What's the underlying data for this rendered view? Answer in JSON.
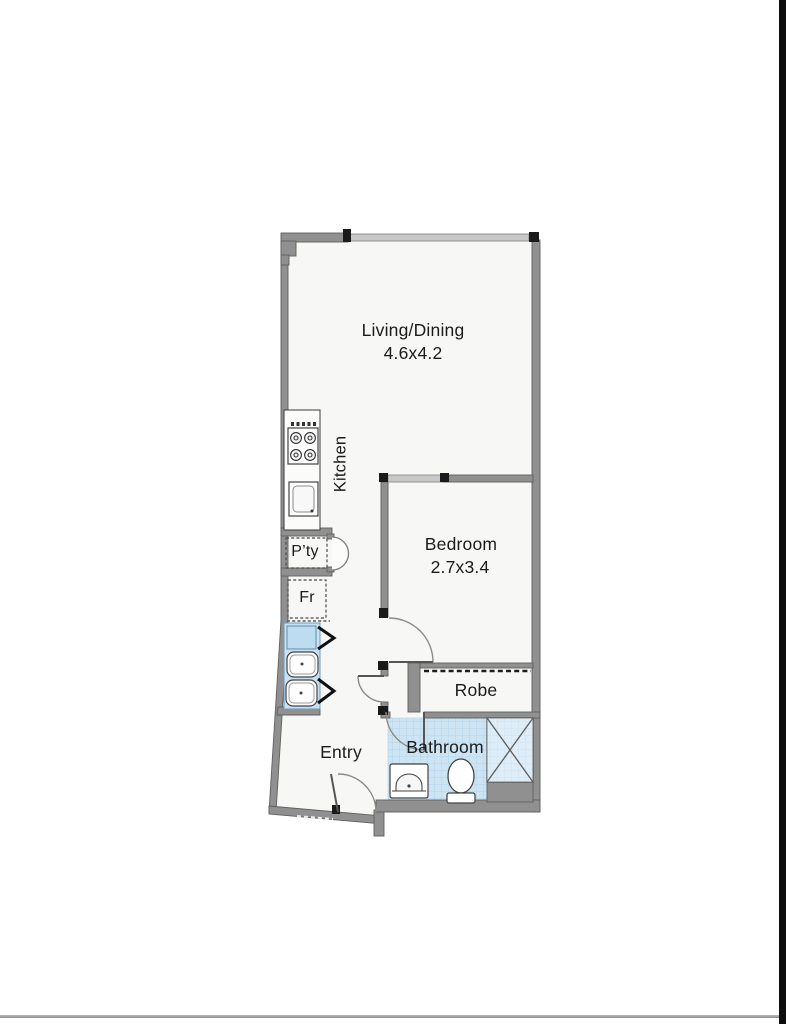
{
  "page": {
    "background": "#ffffff",
    "right_edge_bar_color": "#0e0e0e",
    "bottom_divider_color": "#9c9c9c"
  },
  "floorplan": {
    "colors": {
      "wall": "#909090",
      "wall_outline": "#5f5f5f",
      "window": "#c8c8c8",
      "post": "#1a1a1a",
      "floor": "#f7f7f5",
      "tile": "#cde4f3",
      "tile_grid": "#b3d3e8",
      "laundry_fill": "#c9e1f2",
      "door_arc": "#8a8a8a"
    },
    "rooms": {
      "living": {
        "label": "Living/Dining",
        "dims": "4.6x4.2"
      },
      "kitchen": {
        "label": "Kitchen"
      },
      "pantry": {
        "label": "P’ty"
      },
      "fridge": {
        "label": "Fr"
      },
      "bedroom": {
        "label": "Bedroom",
        "dims": "2.7x3.4"
      },
      "robe": {
        "label": "Robe"
      },
      "bathroom": {
        "label": "Bathroom"
      },
      "entry": {
        "label": "Entry"
      }
    },
    "fixtures": [
      "stove-icon",
      "kitchen-sink-icon",
      "pantry-door-icon",
      "fridge-space",
      "washer-icon",
      "laundry-tub-icon",
      "bifold-door-icon",
      "robe-sliding-track-icon",
      "shower-icon",
      "toilet-icon",
      "vanity-basin-icon",
      "door-swing-icon",
      "window-icon"
    ]
  }
}
